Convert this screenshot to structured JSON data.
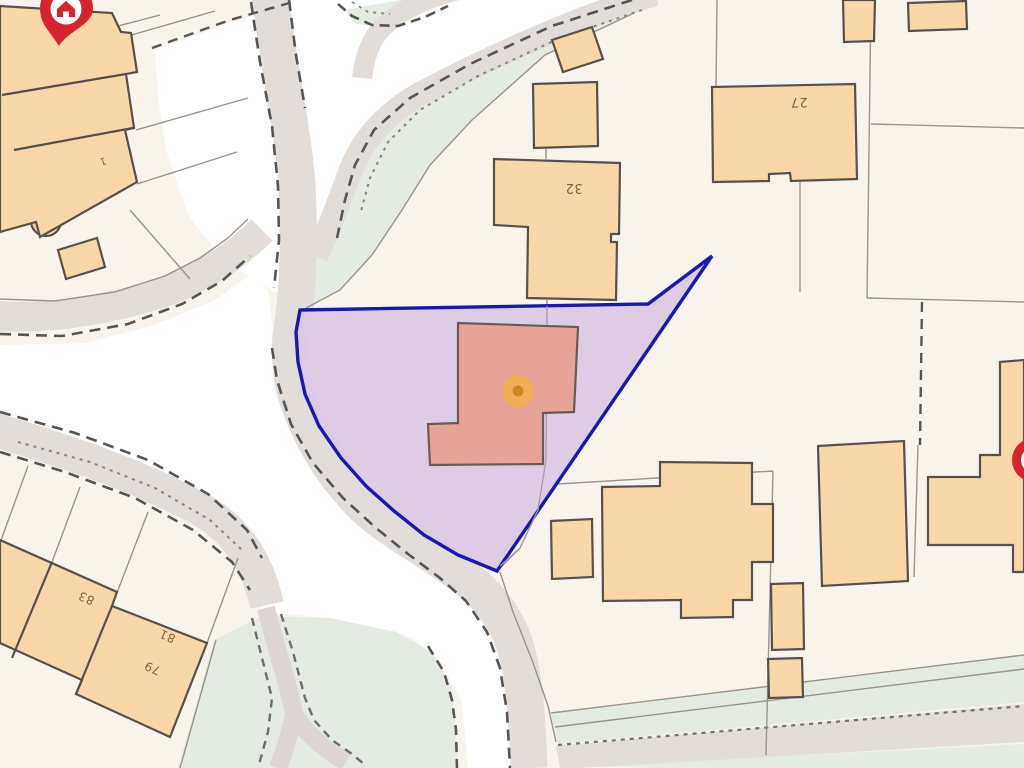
{
  "map": {
    "type": "property-boundary-map",
    "building_labels": [
      {
        "id": "house-1",
        "text": "1"
      },
      {
        "id": "house-32",
        "text": "32"
      },
      {
        "id": "house-27",
        "text": "27"
      },
      {
        "id": "house-83",
        "text": "83"
      },
      {
        "id": "house-81",
        "text": "81"
      },
      {
        "id": "house-79",
        "text": "79"
      }
    ],
    "markers": [
      {
        "name": "home-pin-top-left",
        "icon": "home-pin-icon",
        "color": "#d7232e"
      },
      {
        "name": "home-pin-right-edge",
        "icon": "home-pin-icon",
        "color": "#d7232e"
      },
      {
        "name": "property-center-dot",
        "icon": "orange-dot-icon",
        "color": "#cf861b"
      }
    ],
    "colors": {
      "background_cream": "#f8f4ec",
      "open_area_white": "#ffffff",
      "road_fill": "#e2ddd9",
      "green_area": "#e4ebe2",
      "building_fill": "#f8d8a9",
      "building_stroke": "#56514c",
      "parcel_line": "#9a948a",
      "dashed_boundary": "#565656",
      "selection_fill": "#dcc7e3",
      "selection_border": "#1a18b0",
      "selected_building_fill": "#e7a397",
      "marker_halo": "#f4b04e",
      "marker_dot": "#cf861b",
      "pin_red": "#d7232e",
      "label_color": "#8a6140"
    }
  }
}
